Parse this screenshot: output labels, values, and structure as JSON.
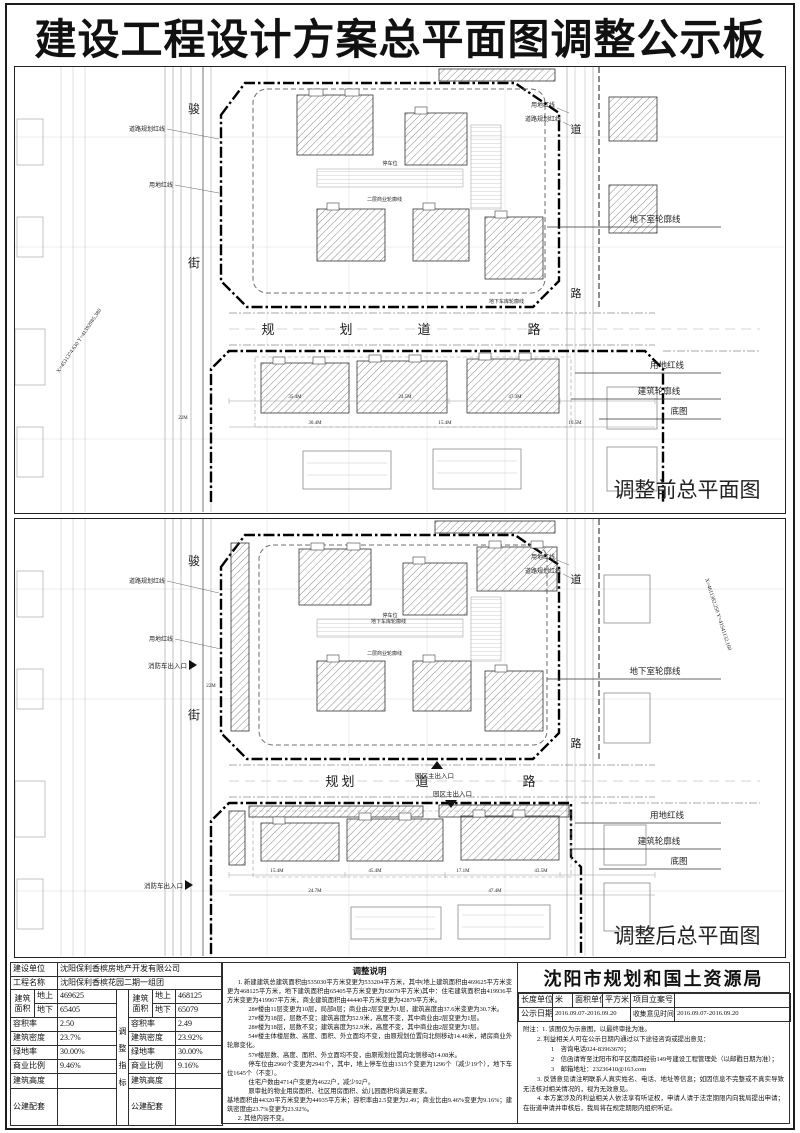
{
  "page": {
    "title": "建设工程设计方案总平面图调整公示板"
  },
  "map_before": {
    "caption": "调整前总平面图",
    "street_left_top": "骏",
    "street_left_bottom": "街",
    "street_right_top": "道",
    "street_right_bottom": "路",
    "road_char_1": "规",
    "road_char_2": "划",
    "road_char_3": "道",
    "road_char_4": "路",
    "callout_basement": "地下室轮廓线",
    "callout_redline": "用地红线",
    "callout_outline": "建筑轮廓线",
    "callout_base": "底图",
    "label_road_redline": "道路规划红线",
    "label_land_redline": "用地红线",
    "label_parking": "停车位",
    "label_biz_outline": "二层商业轮廓线",
    "label_garage": "地下车库轮廓线",
    "coord_text": "X=4531374.630 Y=41392985.380",
    "dim_1": "35.4M",
    "dim_2": "24.5M",
    "dim_3": "47.3M",
    "dim_4": "30.4M",
    "dim_5": "15.4M",
    "dim_6": "10.5M",
    "dim_7": "22M"
  },
  "map_after": {
    "caption": "调整后总平面图",
    "street_left_top": "骏",
    "street_left_bottom": "街",
    "street_right_top": "道",
    "street_right_bottom": "路",
    "road_char_1": "规",
    "road_char_2": "划",
    "road_char_3": "道",
    "road_char_4": "路",
    "callout_basement": "地下室轮廓线",
    "callout_redline": "用地红线",
    "callout_outline": "建筑轮廓线",
    "callout_base": "底图",
    "label_road_redline": "道路规划红线",
    "label_land_redline": "用地红线",
    "label_parking": "停车位",
    "label_biz_outline": "二层商业轮廓线",
    "label_garage": "地下车库轮廓线",
    "label_fire_exit": "消防车出入口",
    "label_main_entrance": "园区主出入口",
    "coord_text": "X=4611382.250 Y=41541132.160",
    "dim_1": "15.4M",
    "dim_2": "45.4M",
    "dim_3": "17.1M",
    "dim_4": "43.5M",
    "dim_5": "24.7M",
    "dim_6": "47.4M",
    "dim_7": "22M"
  },
  "info_table": {
    "owner_label": "建设单位",
    "owner_value": "沈阳保利香槟房地产开发有限公司",
    "project_label": "工程名称",
    "project_value": "沈阳保利香槟花园二期一组团",
    "area_label_top": "建筑",
    "area_label_bottom": "面积",
    "above_label": "地上",
    "below_label": "地下",
    "far_label": "容积率",
    "density_label": "建筑密度",
    "green_label": "绿地率",
    "biz_label": "商业比例",
    "height_label": "建筑高度",
    "public_label": "公建配套",
    "divider_c1": "调",
    "divider_c2": "整",
    "divider_c3": "指",
    "divider_c4": "标",
    "orig": {
      "above": "469625",
      "below": "65405",
      "far": "2.50",
      "density": "23.7%",
      "green": "30.00%",
      "biz": "9.46%"
    },
    "adj": {
      "above": "468125",
      "below": "65079",
      "far": "2.49",
      "density": "23.92%",
      "green": "30.00%",
      "biz": "9.16%"
    }
  },
  "adjustment": {
    "title": "调整说明",
    "lines": [
      "1. 新建建筑总建筑面积由535030平方米变更为533204平方米，其中(地上建筑面积由469625平方米变更为468125平方米，地下建筑面积由65405平方米变更为65079平方米)其中：住宅建筑面积由419936平方米变更为419967平方米，商业建筑面积由44440平方米变更为42879平方米。",
      "28#楼由11层变更为10层，局部8层；商业由2层变更为1层，建筑高度由37.6米变更为30.7米。",
      "27#楼为18层，层数不变；建筑高度为52.9米，高度不变，其中商业由2层变更为1层。",
      "28#楼为18层，层数不变；建筑高度为52.9米，高度不变，其中商业由2层变更为1层。",
      "54#楼主体楼层数、高度、面积、外立面均不变，由原规划位置向北侧移动14.48米，裙房商业外轮廓变化。",
      "57#楼层数、高度、面积、外立面均不变，由原规划位置向北侧移动14.08米。",
      "停车位由2960个变更为2941个，其中，地上停车位由1315个变更为1296个（减少19个），地下车位1645个（不变）。",
      "住宅户数由4714户变更为4622户，减少92户。",
      "原审批的物业用房面积、社区用房面积、幼儿园面积均满足要求。",
      "基地面积由44320平方米变更为44935平方米；容积率由2.5变更为2.49；商业比由9.46%变更为9.16%；建筑密度由23.7%变更为23.92%。",
      "2. 其他内容不变。"
    ]
  },
  "bureau": {
    "name": "沈阳市规划和国土资源局",
    "len_label": "长度单位",
    "len_value": "米",
    "area_label": "面积单位",
    "area_value": "平方米",
    "case_label": "项目立案号",
    "case_value": "",
    "publish_label": "公示日期",
    "publish_value": "2016.09.07-2016.09.20",
    "collect_label": "收集意见时间",
    "collect_value": "2016.09.07-2016.09.20",
    "notes": [
      "附注：1. 该图仅为示意图，以最终审批为准。",
      "2. 利益相关人可在公示日期内通过以下途径咨询或提出意见：",
      "1　咨询电话024-83963670；",
      "2　信函请寄至沈阳市和平区南四经街149号建设工程管理处（以邮戳日期为准）；",
      "3　邮箱地址：23236410@163.com",
      "3. 反馈意见请注明联系人真实姓名、电话、地址等信息；如因信息不完整或不真实导致无法核对相关情况的，视为无效意见。",
      "4. 本方案涉及的利益相关人依法享有听证权，申请人请于法定期限内向我局提出申请；在街道申请并审核后，我局将在规定期限内组织听证。"
    ]
  }
}
